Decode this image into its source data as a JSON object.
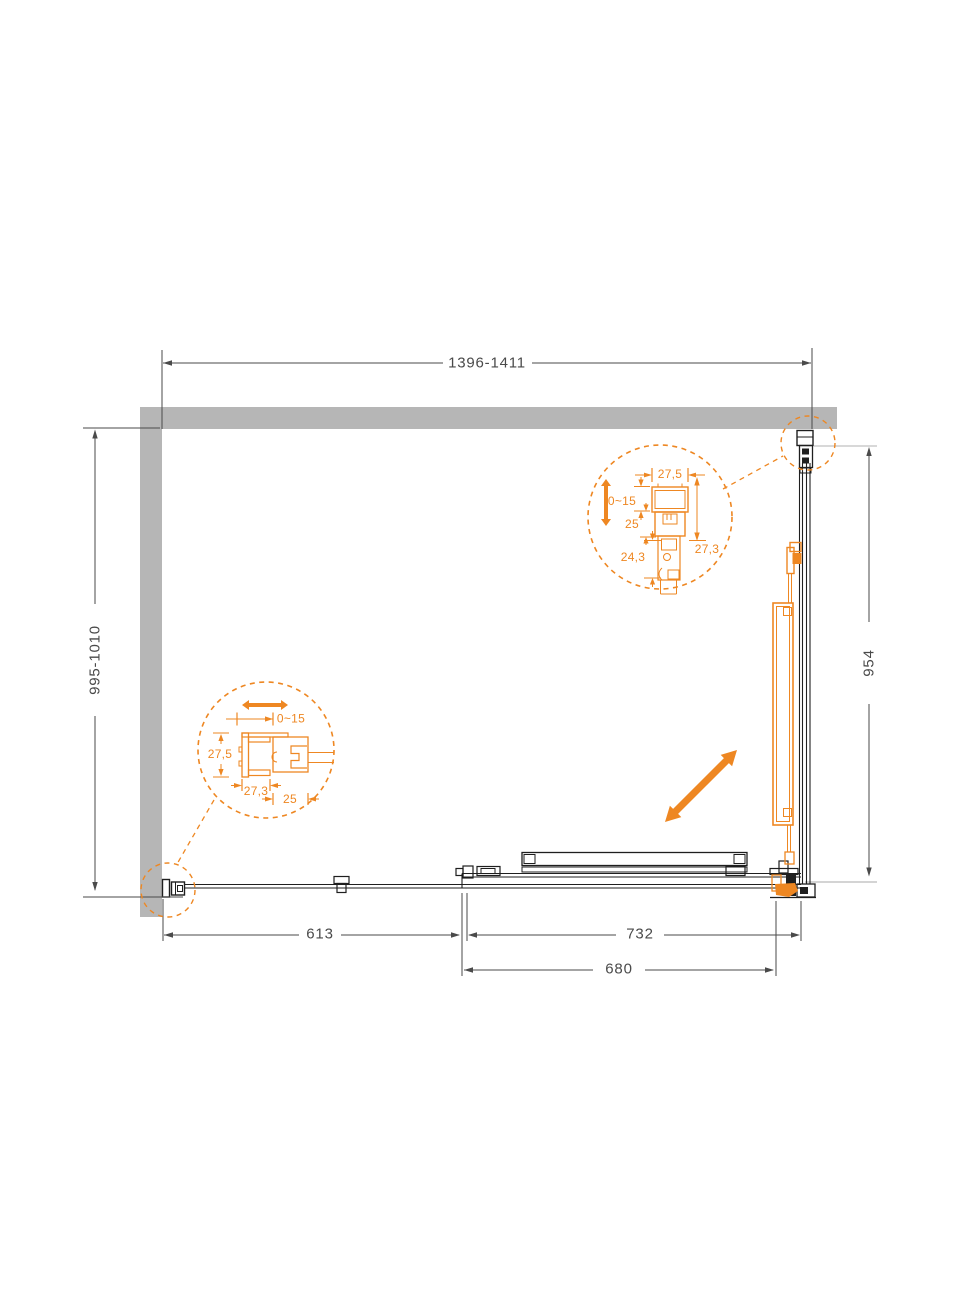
{
  "colors": {
    "bg": "#ffffff",
    "wall": "#b6b6b6",
    "line": "#1f1f1f",
    "dim": "#4a4a4a",
    "accent": "#ee8722",
    "ref": "#cccccc"
  },
  "dimensions": {
    "top_width": "1396-1411",
    "left_height": "995-1010",
    "right_height": "954",
    "bottom_left": "613",
    "bottom_right": "732",
    "bottom_door": "680"
  },
  "detail_top_right": {
    "profile_width": "27,5",
    "adjustment": "0~15",
    "inner_depth": "25",
    "profile_depth": "27,3",
    "glass_inset": "24,3"
  },
  "detail_bottom_left": {
    "adjustment": "0~15",
    "profile_height": "27,5",
    "profile_width": "27,3",
    "inner_width": "25"
  }
}
